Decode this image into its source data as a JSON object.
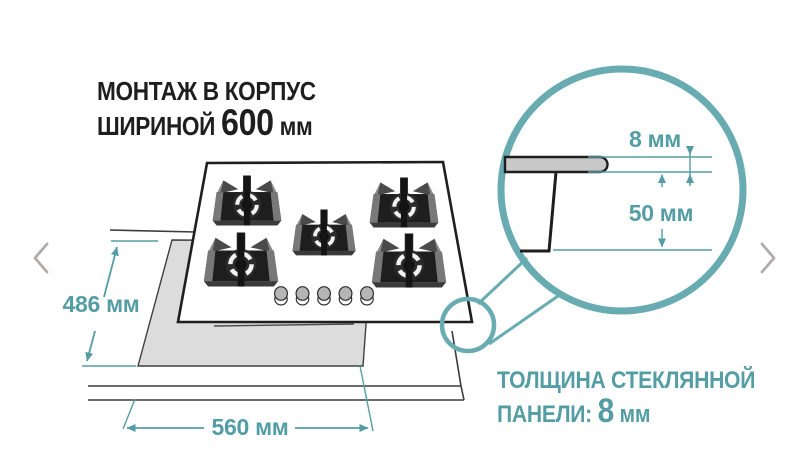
{
  "title": {
    "line1": "МОНТАЖ В КОРПУС",
    "line2_prefix": "ШИРИНОЙ",
    "line2_value": "600",
    "line2_unit": "мм"
  },
  "dimensions": {
    "cutout_depth": "486 мм",
    "cutout_width": "560 мм",
    "glass_thickness": "8 мм",
    "cabinet_clearance": "50 мм"
  },
  "caption": {
    "line1": "ТОЛЩИНА СТЕКЛЯННОЙ",
    "line2_prefix": "ПАНЕЛИ:",
    "line2_value": "8",
    "line2_unit": "мм"
  },
  "hob": {
    "burners": 5,
    "knobs": 5
  },
  "nav": {
    "prev_icon": "chevron-left",
    "next_icon": "chevron-right"
  },
  "colors": {
    "accent_teal": "#549da4",
    "circle_teal": "#68acb2",
    "ink": "#1e1e1e",
    "line_gray": "#3c3c3c",
    "cutout_gray": "#dcdcdc",
    "glass_gray": "#c8c8c8",
    "chevron_gray": "#b3abab"
  }
}
